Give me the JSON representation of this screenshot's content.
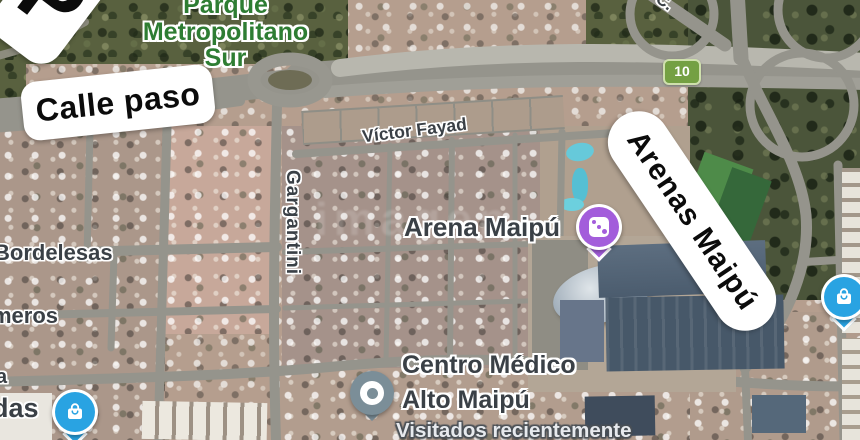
{
  "map": {
    "watermark": "imagen",
    "route_shield": "10",
    "park_label": {
      "line1": "Parque",
      "line2": "Metropolitano",
      "line3": "Sur"
    },
    "pills": {
      "partial_letter": "P",
      "calle_paso": "Calle paso",
      "arenas_maipu": "Arenas Maipú"
    },
    "streets": {
      "victor_fayad": "Víctor Fayad",
      "gargantini": "Gargantini",
      "bordelesas": "Bordelesas",
      "meros_partial": "meros",
      "a_partial": "a",
      "das_partial": "das",
      "c_partial": "C."
    },
    "pois": {
      "arena_maipu": {
        "label": "Arena Maipú",
        "icon": "casino-dice-pin",
        "pin_color": "#a35ddb"
      },
      "centro_medico": {
        "line1": "Centro Médico",
        "line2": "Alto Maipú",
        "status": "Visitados recientemente",
        "icon": "visited-place-pin",
        "pin_color": "#7b8e98"
      },
      "shopping_left": {
        "icon": "shopping-bag-pin",
        "pin_color": "#29a3e2"
      },
      "shopping_right": {
        "icon": "shopping-bag-pin",
        "pin_color": "#29a3e2"
      }
    },
    "colors": {
      "road": "#95948c",
      "highway_light": "#b8b7ae",
      "dirt": "#b59e8e",
      "dirt_lot": "#c7a89a",
      "vegetation": "#59613f",
      "park_text_green": "#2e7d33",
      "shield_green": "#74a043",
      "label_dark": "#3a4046",
      "arena_roof": "#4b5c6e"
    }
  }
}
